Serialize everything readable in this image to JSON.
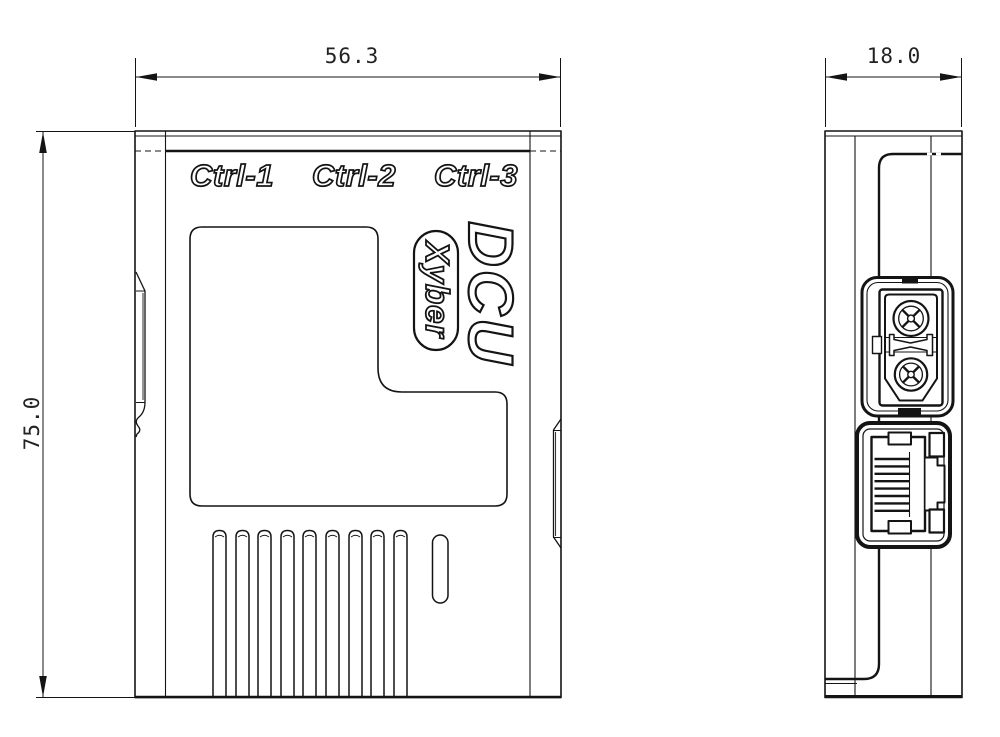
{
  "front": {
    "dim_width": "56.3",
    "dim_height": "75.0",
    "ctrl_labels": [
      "Ctrl-1",
      "Ctrl-2",
      "Ctrl-3"
    ],
    "product_name": "DCU",
    "brand": "Xyber"
  },
  "side": {
    "dim_width": "18.0",
    "port_icons": [
      "xt30-power-connector-icon",
      "rj45-ethernet-port-icon"
    ]
  },
  "colors": {
    "line": "#141414",
    "background": "#ffffff"
  }
}
